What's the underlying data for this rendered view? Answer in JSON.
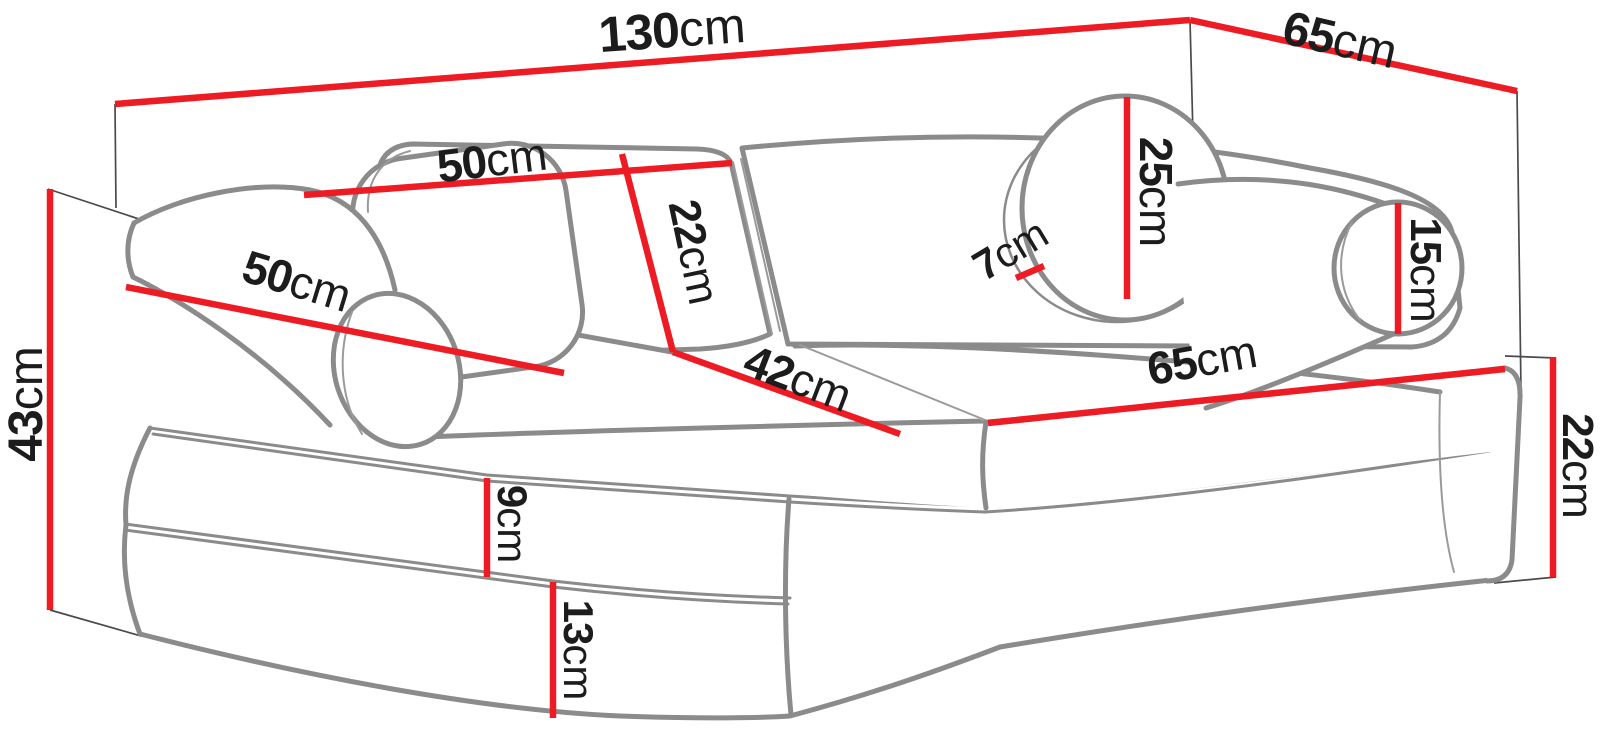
{
  "diagram": {
    "type": "furniture-dimension-diagram",
    "subject": "modular kids play sofa (fold-out foam couch) with bolsters and round pillow, shown with measurements",
    "unit": "cm",
    "background_color": "#ffffff",
    "colors": {
      "dimension_line": "#ed1c24",
      "sofa_outline": "#8b8b8b",
      "label_text": "#1c1c1c",
      "projection_line": "#4a4a4a"
    },
    "dimensions": {
      "total_width": {
        "value": "130",
        "unit": "cm",
        "description": "overall width along the back top edge"
      },
      "total_depth": {
        "value": "65",
        "unit": "cm",
        "description": "overall depth at the top right edge"
      },
      "back_cushion_width": {
        "value": "50",
        "unit": "cm",
        "description": "width of a backrest cushion"
      },
      "bolster_length": {
        "value": "50",
        "unit": "cm",
        "description": "length of the left bolster pillow"
      },
      "back_cushion_height": {
        "value": "22",
        "unit": "cm",
        "description": "height of the backrest cushion"
      },
      "round_pillow_diameter": {
        "value": "25",
        "unit": "cm",
        "description": "diameter of the round pillow"
      },
      "round_pillow_thickness": {
        "value": "7",
        "unit": "cm",
        "description": "thickness of the round pillow"
      },
      "side_bolster_diameter": {
        "value": "15",
        "unit": "cm",
        "description": "diameter of the right bolster pillow"
      },
      "seat_depth": {
        "value": "42",
        "unit": "cm",
        "description": "seat depth in front of the backrest"
      },
      "seat_cushion_width": {
        "value": "65",
        "unit": "cm",
        "description": "width of one seat cushion"
      },
      "total_height": {
        "value": "43",
        "unit": "cm",
        "description": "overall height at the left side"
      },
      "top_mattress_height": {
        "value": "9",
        "unit": "cm",
        "description": "height of the upper foam layer"
      },
      "bottom_mattress_height": {
        "value": "13",
        "unit": "cm",
        "description": "height of the lower foam layer"
      },
      "seat_cushion_height": {
        "value": "22",
        "unit": "cm",
        "description": "seat cushion height at the right end"
      }
    }
  }
}
